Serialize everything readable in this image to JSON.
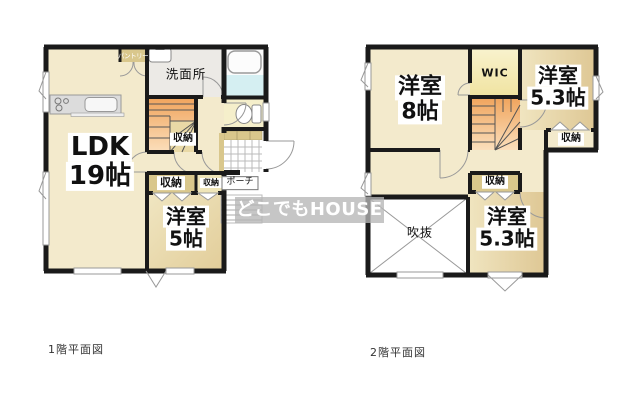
{
  "watermark": "どこでもHOUSE",
  "floor1": {
    "caption": "1階平面図",
    "labels": {
      "ldk": {
        "line1": "LDK",
        "line2": "19帖"
      },
      "bedroom5": {
        "line1": "洋室",
        "line2": "5帖"
      },
      "washroom": "洗面所",
      "pantry": "パントリー",
      "closet_stair": "収納",
      "closet_main": "収納",
      "closet_small": "収納",
      "porch": "ポーチ"
    }
  },
  "floor2": {
    "caption": "2階平面図",
    "labels": {
      "bedroom8": {
        "line1": "洋室",
        "line2": "8帖"
      },
      "wic": "WIC",
      "bedroom53_top": {
        "line1": "洋室",
        "line2": "5.3帖"
      },
      "closet_top": "収納",
      "closet_mid": "収納",
      "bedroom53_bottom": {
        "line1": "洋室",
        "line2": "5.3帖"
      },
      "void": "吹抜"
    }
  },
  "colors": {
    "wall": "#1a1a1a",
    "room_cream": "#F3EACC",
    "room_tan": "#E2CD99",
    "washroom_gray": "#ECEAE6",
    "wic_yellow": "#F7EFB9",
    "bath_cyan": "#D5EFF2",
    "stair_orange": "#F2A35C",
    "closet_strip": "#D9C78C"
  }
}
